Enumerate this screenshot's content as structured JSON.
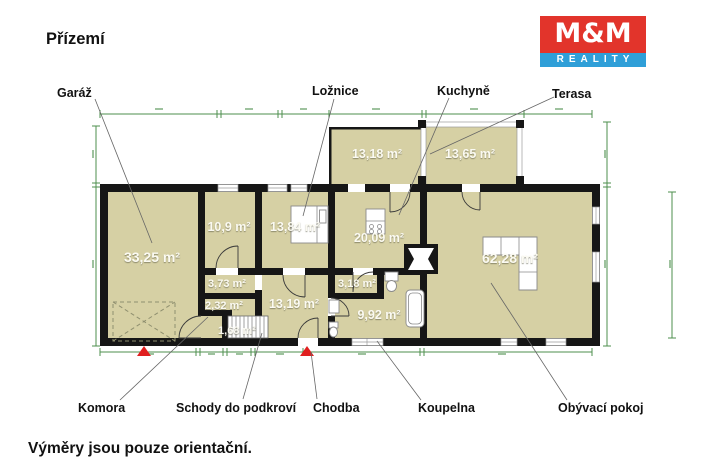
{
  "title": "Přízemí",
  "footer_note": "Výměry jsou pouze orientační.",
  "logo": {
    "top": "M&M",
    "bottom": "REALITY"
  },
  "colors": {
    "room_fill": "#d6d0a4",
    "wall": "#161616",
    "dimension_line": "#4e8f4e",
    "entrance_marker": "#e01f1f",
    "logo_red": "#e2342b",
    "logo_blue": "#2f9fd8",
    "area_text": "#fbfaf2",
    "label_text": "#111111"
  },
  "callouts": {
    "garage": "Garáž",
    "bedroom": "Ložnice",
    "kitchen": "Kuchyně",
    "terrace": "Terasa",
    "pantry": "Komora",
    "stairs": "Schody do podkroví",
    "hallway": "Chodba",
    "bathroom": "Koupelna",
    "living_room": "Obývací pokoj"
  },
  "areas": {
    "garage": "33,25 m²",
    "room_small_top": "10,9 m²",
    "bedroom": "13,84 m²",
    "annex": "13,18 m²",
    "terrace": "13,65 m²",
    "kitchen": "20,09 m²",
    "living_room": "62,28 m²",
    "closet_a": "3,73 m²",
    "closet_b": "2,32 m²",
    "closet_c": "1,68 m²",
    "hallway": "13,19 m²",
    "wc": "3,18 m²",
    "bathroom": "9,92 m²"
  }
}
